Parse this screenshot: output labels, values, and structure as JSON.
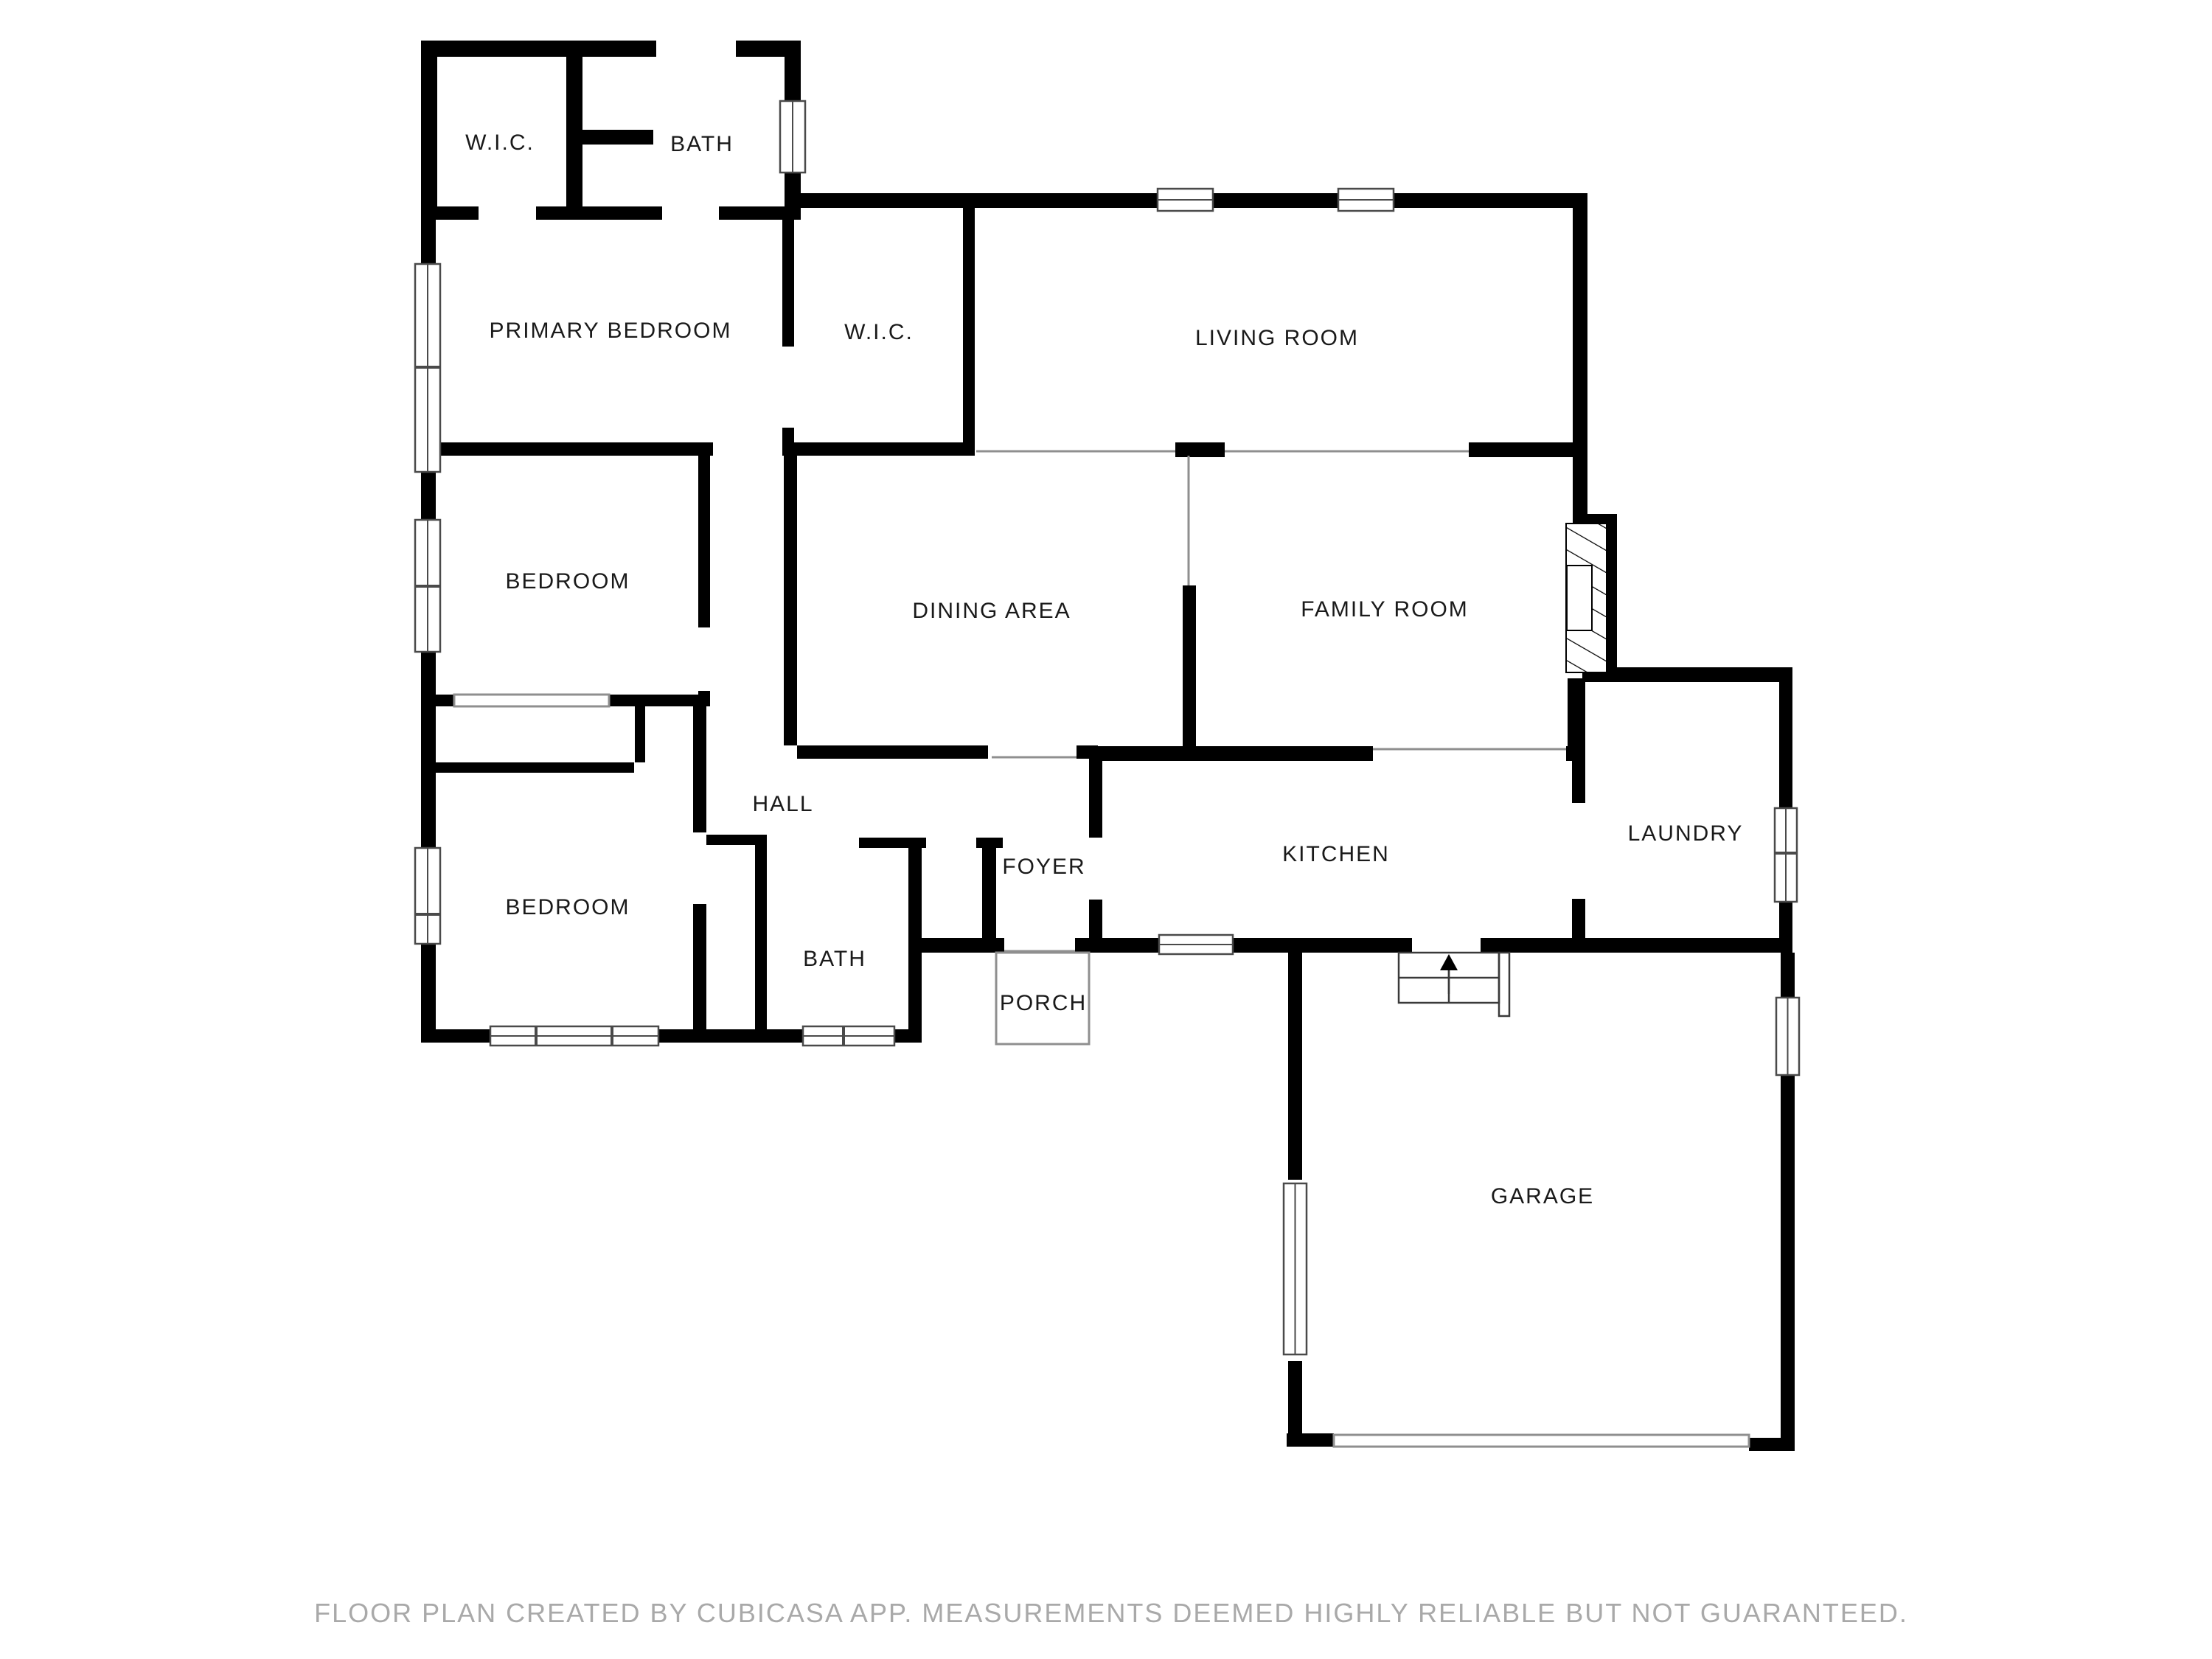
{
  "title": "Floor plan",
  "rooms": {
    "wic1": {
      "label": "W.I.C."
    },
    "bath1": {
      "label": "BATH"
    },
    "primary": {
      "label": "PRIMARY BEDROOM"
    },
    "wic2": {
      "label": "W.I.C."
    },
    "living": {
      "label": "LIVING ROOM"
    },
    "bedroom1": {
      "label": "BEDROOM"
    },
    "dining": {
      "label": "DINING AREA"
    },
    "family": {
      "label": "FAMILY ROOM"
    },
    "hall": {
      "label": "HALL"
    },
    "kitchen": {
      "label": "KITCHEN"
    },
    "laundry": {
      "label": "LAUNDRY"
    },
    "foyer": {
      "label": "FOYER"
    },
    "bath2": {
      "label": "BATH"
    },
    "porch": {
      "label": "PORCH"
    },
    "bedroom2": {
      "label": "BEDROOM"
    },
    "garage": {
      "label": "GARAGE"
    }
  },
  "footer": {
    "text": "FLOOR PLAN CREATED BY CUBICASA APP. MEASUREMENTS DEEMED HIGHLY RELIABLE BUT NOT GUARANTEED."
  },
  "colors": {
    "wall": "#000000",
    "thin_line": "#8f8f8f",
    "window_outline": "#4a4a4a",
    "footer_text": "#a9a9a9",
    "background": "#ffffff"
  }
}
